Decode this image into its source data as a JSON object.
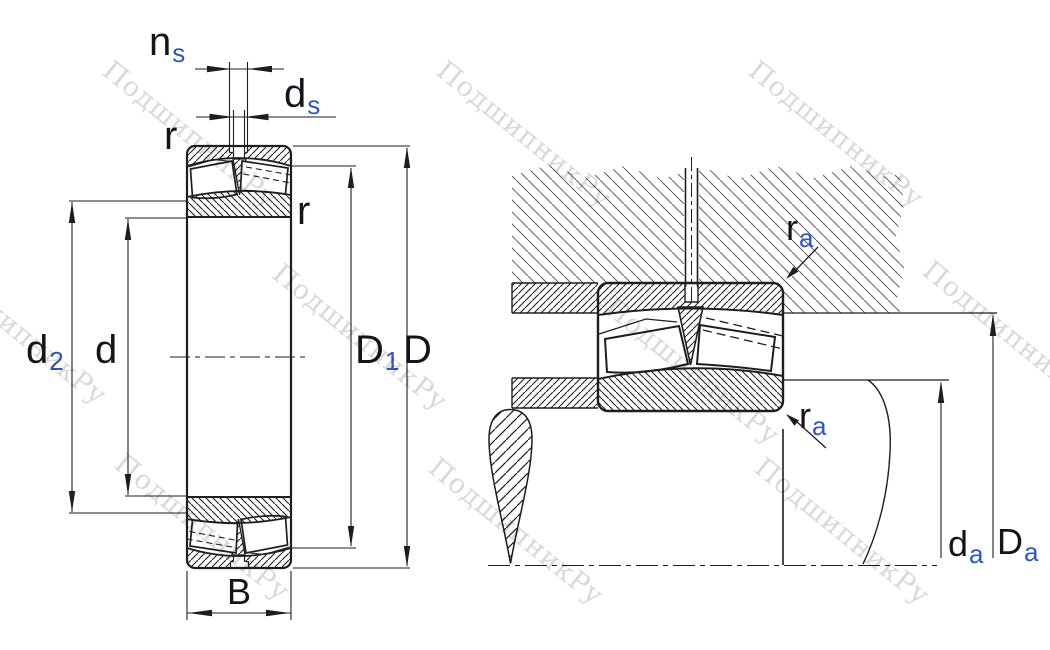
{
  "watermark": {
    "text": "ПодшипникРу"
  },
  "drawing": {
    "left_view_labels": {
      "ns": {
        "base": "n",
        "sub": "s"
      },
      "ds": {
        "base": "d",
        "sub": "s"
      },
      "r_outer": "r",
      "r_inner": "r",
      "d2": {
        "base": "d",
        "sub": "2"
      },
      "d": "d",
      "D1": {
        "base": "D",
        "sub": "1"
      },
      "D": "D",
      "B": "B"
    },
    "right_view_labels": {
      "ra_top": {
        "base": "r",
        "sub": "a"
      },
      "ra_bottom": {
        "base": "r",
        "sub": "a"
      },
      "da": {
        "base": "d",
        "sub": "a"
      },
      "Da": {
        "base": "D",
        "sub": "a"
      }
    }
  },
  "colors": {
    "line": "#1e1e20",
    "label": "#14151c",
    "subscript": "#2e57c5",
    "watermark": "#d9d9d9",
    "housing_hatch": "#606064",
    "background": "#ffffff"
  }
}
